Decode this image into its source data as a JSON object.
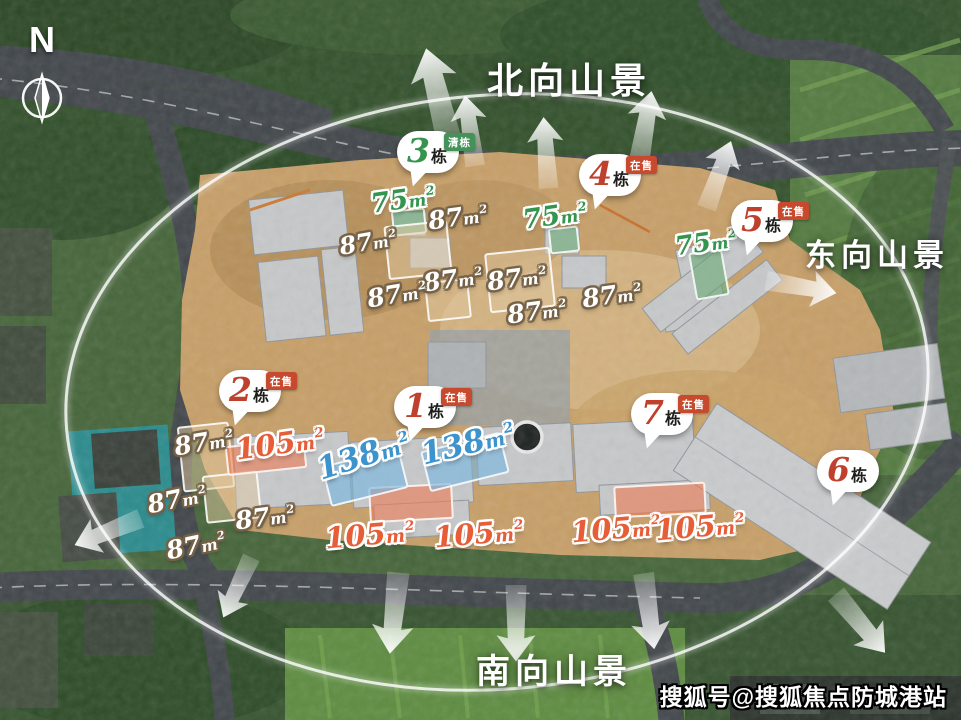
{
  "compass": {
    "label": "N"
  },
  "view_labels": [
    {
      "name": "north-view",
      "text": "北向山景"
    },
    {
      "name": "east-view",
      "text": "东向山景"
    },
    {
      "name": "south-view",
      "text": "南向山景"
    }
  ],
  "watermark": {
    "text": "搜狐号@搜狐焦点防城港站"
  },
  "palette": {
    "green": "#35944e",
    "orange": "#e75d38",
    "blue": "#3d93cc",
    "num_red": "#bf402c",
    "num_green": "#35944e",
    "badge_selling": "#c7492e",
    "badge_clearing": "#44925a"
  },
  "dong_suffix": "栋",
  "area_unit": {
    "m": "m",
    "sup": "2"
  },
  "buildings": [
    {
      "num": "3",
      "badge": "清栋",
      "status": "clearing",
      "num_color": "num_green",
      "x": 428,
      "y": 152
    },
    {
      "num": "4",
      "badge": "在售",
      "status": "selling",
      "num_color": "num_red",
      "x": 610,
      "y": 175
    },
    {
      "num": "5",
      "badge": "在售",
      "status": "selling",
      "num_color": "num_red",
      "x": 762,
      "y": 221
    },
    {
      "num": "2",
      "badge": "在售",
      "status": "selling",
      "num_color": "num_red",
      "x": 250,
      "y": 391
    },
    {
      "num": "1",
      "badge": "在售",
      "status": "selling",
      "num_color": "num_red",
      "x": 425,
      "y": 407
    },
    {
      "num": "7",
      "badge": "在售",
      "status": "selling",
      "num_color": "num_red",
      "x": 662,
      "y": 414
    },
    {
      "num": "6",
      "badge": null,
      "status": "none",
      "num_color": "num_red",
      "x": 848,
      "y": 471
    }
  ],
  "unit_labels": [
    {
      "value": "75",
      "variant": "green",
      "x": 403,
      "y": 200,
      "rot": -8,
      "size": 27
    },
    {
      "value": "75",
      "variant": "green",
      "x": 555,
      "y": 216,
      "rot": -8,
      "size": 27
    },
    {
      "value": "75",
      "variant": "green",
      "x": 706,
      "y": 243,
      "rot": -8,
      "size": 26
    },
    {
      "value": "87",
      "variant": "white",
      "x": 458,
      "y": 217,
      "rot": -8,
      "size": 25
    },
    {
      "value": "87",
      "variant": "white",
      "x": 368,
      "y": 242,
      "rot": -10,
      "size": 24
    },
    {
      "value": "87",
      "variant": "white",
      "x": 453,
      "y": 279,
      "rot": -8,
      "size": 25
    },
    {
      "value": "87",
      "variant": "white",
      "x": 397,
      "y": 294,
      "rot": -10,
      "size": 25
    },
    {
      "value": "87",
      "variant": "white",
      "x": 517,
      "y": 278,
      "rot": -8,
      "size": 25
    },
    {
      "value": "87",
      "variant": "white",
      "x": 537,
      "y": 311,
      "rot": -8,
      "size": 25
    },
    {
      "value": "87",
      "variant": "white",
      "x": 612,
      "y": 295,
      "rot": -8,
      "size": 25
    },
    {
      "value": "87",
      "variant": "white",
      "x": 204,
      "y": 442,
      "rot": -10,
      "size": 25
    },
    {
      "value": "87",
      "variant": "white",
      "x": 177,
      "y": 499,
      "rot": -12,
      "size": 25
    },
    {
      "value": "87",
      "variant": "white",
      "x": 265,
      "y": 517,
      "rot": -8,
      "size": 25
    },
    {
      "value": "87",
      "variant": "white",
      "x": 196,
      "y": 545,
      "rot": -12,
      "size": 25
    },
    {
      "value": "105",
      "variant": "orange",
      "x": 280,
      "y": 444,
      "rot": -8,
      "size": 29
    },
    {
      "value": "105",
      "variant": "orange",
      "x": 370,
      "y": 535,
      "rot": -5,
      "size": 29
    },
    {
      "value": "105",
      "variant": "orange",
      "x": 479,
      "y": 534,
      "rot": -5,
      "size": 29
    },
    {
      "value": "105",
      "variant": "orange",
      "x": 616,
      "y": 529,
      "rot": -5,
      "size": 29
    },
    {
      "value": "105",
      "variant": "orange",
      "x": 700,
      "y": 527,
      "rot": -5,
      "size": 29
    },
    {
      "value": "138",
      "variant": "blue",
      "x": 364,
      "y": 456,
      "rot": -18,
      "size": 31
    },
    {
      "value": "138",
      "variant": "blue",
      "x": 468,
      "y": 444,
      "rot": -14,
      "size": 31
    }
  ],
  "footprints": [
    {
      "variant": "green",
      "x": 409,
      "y": 222,
      "w": 34,
      "h": 26,
      "rot": -6
    },
    {
      "variant": "green",
      "x": 564,
      "y": 240,
      "w": 30,
      "h": 26,
      "rot": -6
    },
    {
      "variant": "green",
      "x": 709,
      "y": 274,
      "w": 34,
      "h": 48,
      "rot": -10
    },
    {
      "variant": "tan",
      "x": 206,
      "y": 457,
      "w": 52,
      "h": 66,
      "rot": -6
    },
    {
      "variant": "tan",
      "x": 232,
      "y": 497,
      "w": 56,
      "h": 48,
      "rot": -6
    },
    {
      "variant": "tan",
      "x": 418,
      "y": 250,
      "w": 64,
      "h": 54,
      "rot": -6
    },
    {
      "variant": "tan",
      "x": 520,
      "y": 280,
      "w": 66,
      "h": 60,
      "rot": -6
    },
    {
      "variant": "tan",
      "x": 448,
      "y": 300,
      "w": 44,
      "h": 40,
      "rot": -6
    },
    {
      "variant": "orange",
      "x": 266,
      "y": 457,
      "w": 80,
      "h": 30,
      "rot": -6
    },
    {
      "variant": "orange",
      "x": 411,
      "y": 503,
      "w": 84,
      "h": 36,
      "rot": -3
    },
    {
      "variant": "orange",
      "x": 660,
      "y": 500,
      "w": 92,
      "h": 32,
      "rot": -3
    },
    {
      "variant": "blue",
      "x": 365,
      "y": 477,
      "w": 80,
      "h": 42,
      "rot": -14
    },
    {
      "variant": "blue",
      "x": 465,
      "y": 462,
      "w": 82,
      "h": 42,
      "rot": -14
    }
  ],
  "arrows": [
    {
      "x": 437,
      "y": 92,
      "rot": -14,
      "s": 0.9
    },
    {
      "x": 470,
      "y": 130,
      "rot": -8,
      "s": 0.7
    },
    {
      "x": 546,
      "y": 152,
      "rot": -4,
      "s": 0.7
    },
    {
      "x": 645,
      "y": 128,
      "rot": 10,
      "s": 0.75
    },
    {
      "x": 719,
      "y": 174,
      "rot": 20,
      "s": 0.7
    },
    {
      "x": 802,
      "y": 287,
      "rot": 100,
      "s": 0.7
    },
    {
      "x": 107,
      "y": 532,
      "rot": -112,
      "s": 0.7
    },
    {
      "x": 237,
      "y": 588,
      "rot": 205,
      "s": 0.65
    },
    {
      "x": 394,
      "y": 614,
      "rot": 186,
      "s": 0.8
    },
    {
      "x": 516,
      "y": 624,
      "rot": 180,
      "s": 0.75
    },
    {
      "x": 649,
      "y": 612,
      "rot": 172,
      "s": 0.75
    },
    {
      "x": 861,
      "y": 624,
      "rot": 140,
      "s": 0.75
    }
  ],
  "ring": {
    "cx": 497,
    "cy": 392,
    "rx": 432,
    "ry": 297,
    "rot": -5
  }
}
